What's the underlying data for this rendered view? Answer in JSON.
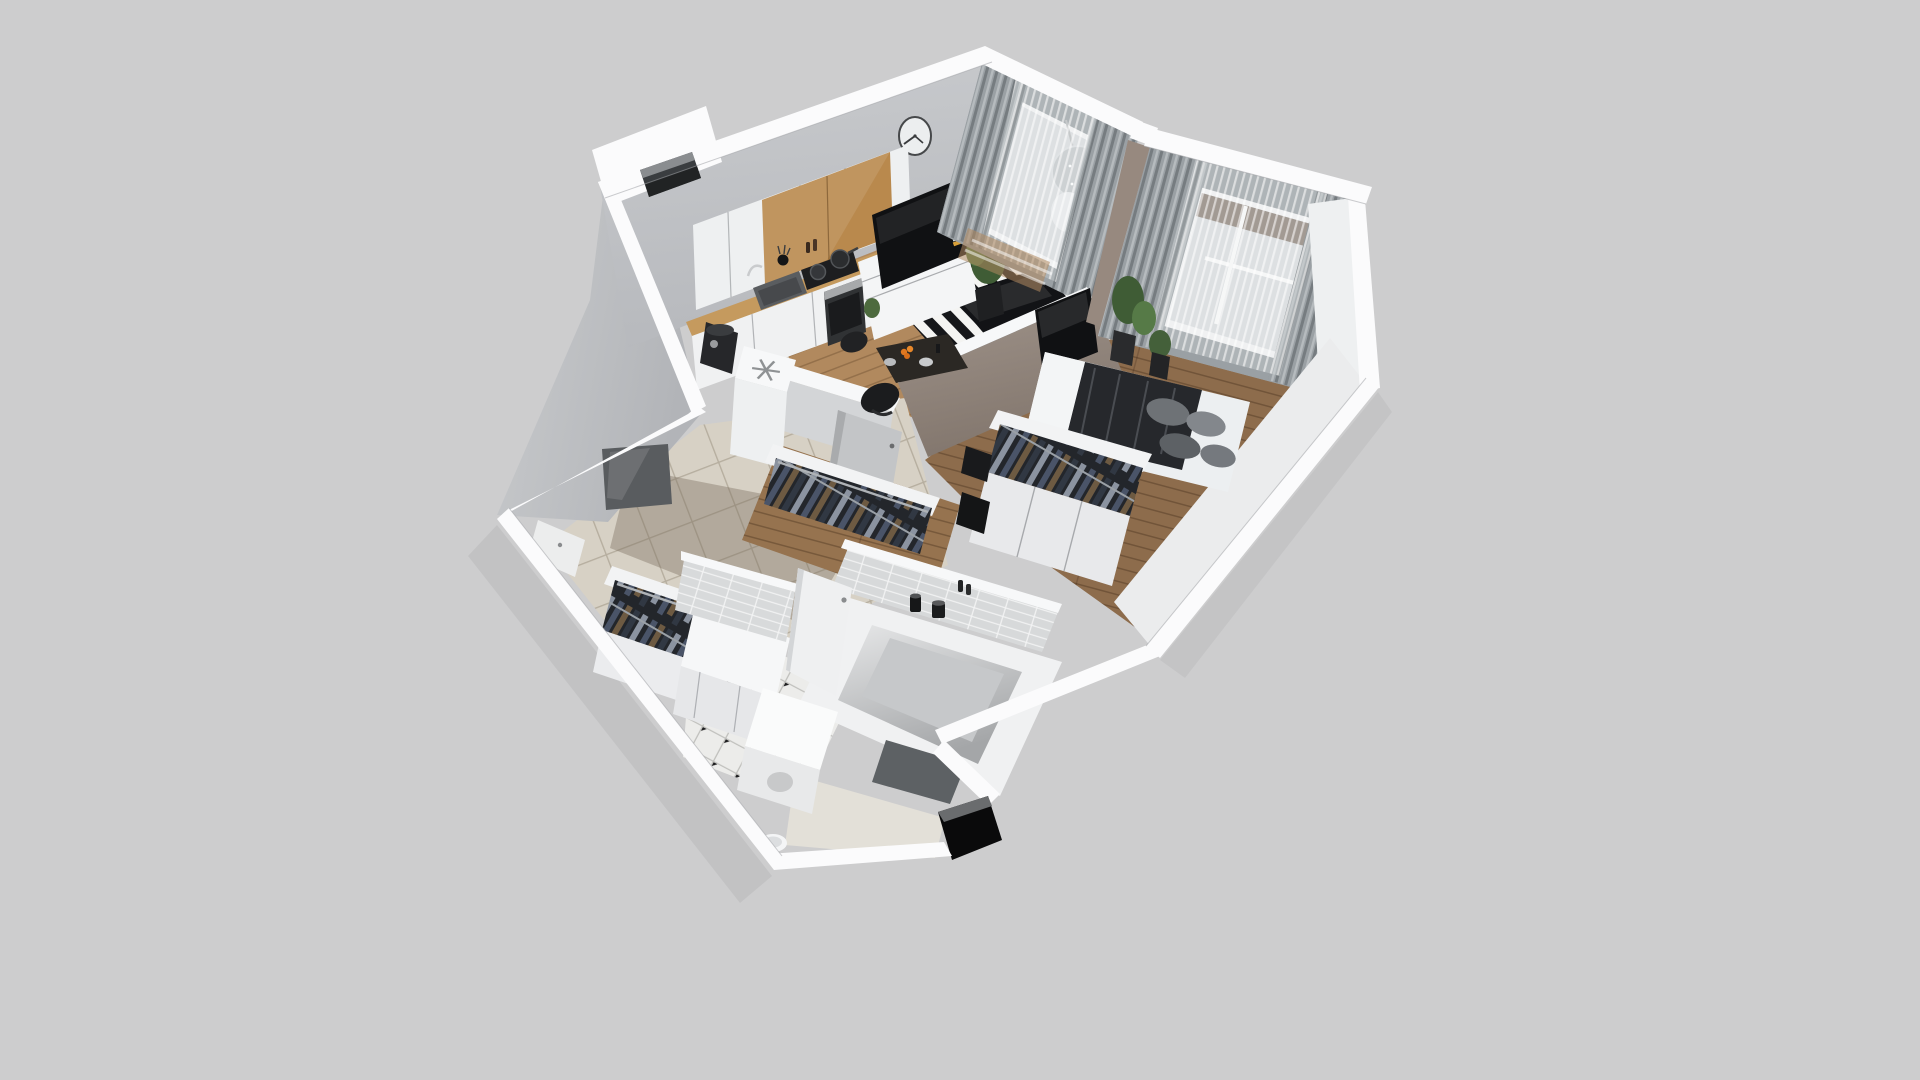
{
  "scene": {
    "description": "Photorealistic 3D dollhouse render of a one-bedroom apartment floor plan, viewed from above at an angle; no visible text anywhere in the image",
    "background_color": "#cdcdce"
  },
  "palette": {
    "wall_top": "#fbfbfc",
    "wall_face": "#c5c7ca",
    "wall_face_dark": "#b4b6ba",
    "taupe_wall": "#97897f",
    "wood_living": "#b1895e",
    "wood_bedroom": "#8d6c4c",
    "wood_closet": "#96734f",
    "tile_hall": "#d7d1c5",
    "tile_bath": "#ececea",
    "rug_dark": "#16171a",
    "rug_light": "#f4f4f2",
    "curtain_gray": "#9aa0a4",
    "sheer_white": "#e6e9eb",
    "window_glass": "#d8dbde",
    "tv_black": "#101113",
    "counter_wood": "#c59a5e",
    "cabinet_wood": "#b9894d",
    "plant_green": "#4d6a3e",
    "bed_blanket": "#26282c",
    "pillow_gray": "#83878c",
    "doorway_black": "#0a0a0b",
    "mirror_gray": "#595c5f"
  },
  "rooms": [
    {
      "id": "kitchen-living",
      "label": "Kitchen / Living room",
      "features": [
        "white upper cabinets with oak panel",
        "wall clock",
        "sink with chrome faucet",
        "black cooktop with two pans",
        "built-in oven",
        "wood countertop",
        "fridge column with snowflake top marking",
        "black coffee machine",
        "TV on white media console",
        "tall potted plant",
        "black-and-white striped rug",
        "dark glass coffee table",
        "charcoal sofa",
        "dark dining table with fruit and plates",
        "black chairs",
        "balcony window with gray curtains and hanging egg chair"
      ]
    },
    {
      "id": "bedroom",
      "label": "Bedroom",
      "features": [
        "double bed with white linen, dark blanket and gray pillows",
        "black round side tray",
        "taupe partition wall with wall-mounted TV",
        "closet with sliding doors and open hanging clothes",
        "black storage boxes",
        "large curtained window with sheer drapes",
        "floor plants"
      ]
    },
    {
      "id": "hallway",
      "label": "Hallway",
      "features": [
        "open clothes rack near bedroom",
        "second open clothes rack near bathroom",
        "white storage cabinet",
        "dark wall mirror panel",
        "gray interior door ajar",
        "front entrance door",
        "beige floor tiles",
        "ventilation shaft opening in wall"
      ]
    },
    {
      "id": "bathroom",
      "label": "Bathroom",
      "features": [
        "white bathtub with black candles and bottles",
        "white subway-tiled walls",
        "octagon tile floor with black diamond dots",
        "washing machine",
        "dark gray bath mat",
        "toilet",
        "white door ajar",
        "black open entrance doorway in outer wall"
      ]
    }
  ]
}
